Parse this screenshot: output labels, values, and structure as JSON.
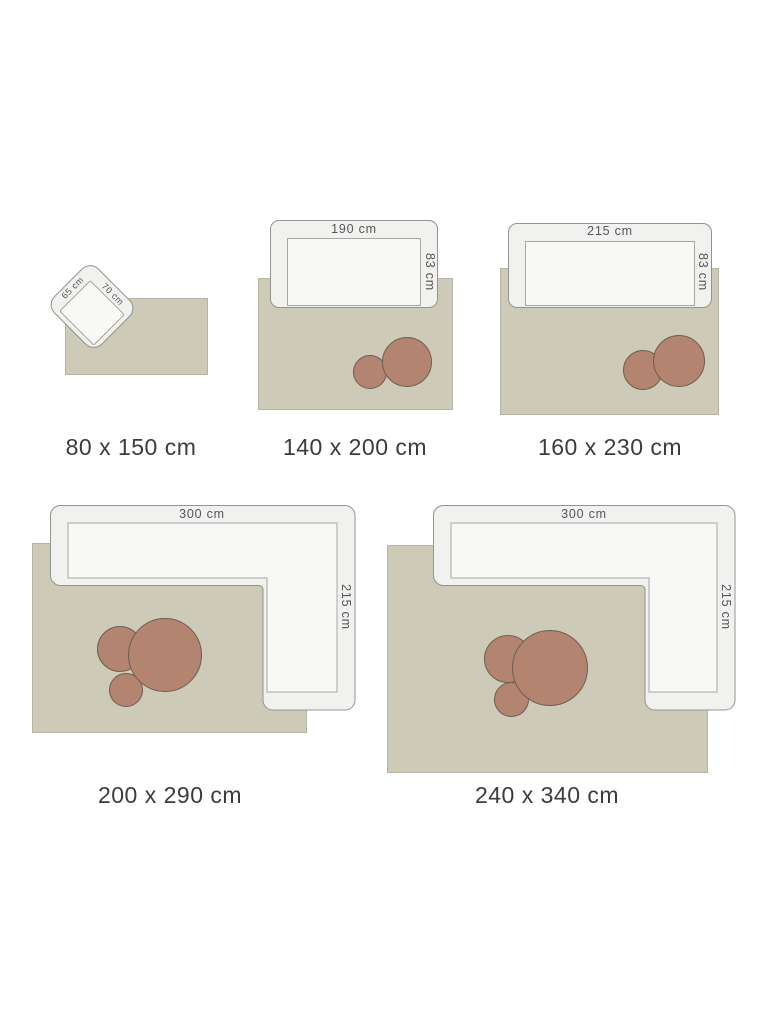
{
  "page": {
    "background": "#ffffff",
    "kind": "rug-size-guide"
  },
  "colors": {
    "rug_fill": "#cdcab7",
    "furniture_fill": "#f1f1ef",
    "furniture_seat_fill": "#f8f8f6",
    "furniture_border": "#94948c",
    "pouf_fill": "#b3846f",
    "pouf_border": "#6f5d51",
    "dimension_text": "#55555a",
    "caption_text": "#3c3c3e"
  },
  "panels": [
    {
      "size": "80 x 150 cm",
      "furniture": "armchair",
      "labels": {
        "width": "70 cm",
        "depth": "65 cm"
      },
      "poufs": 0
    },
    {
      "size": "140 x 200 cm",
      "furniture": "sofa",
      "labels": {
        "width": "190 cm",
        "depth": "83 cm"
      },
      "poufs": 2
    },
    {
      "size": "160 x 230 cm",
      "furniture": "sofa",
      "labels": {
        "width": "215 cm",
        "depth": "83 cm"
      },
      "poufs": 2
    },
    {
      "size": "200 x 290 cm",
      "furniture": "corner-sofa",
      "labels": {
        "width": "300 cm",
        "depth": "215 cm"
      },
      "poufs": 3
    },
    {
      "size": "240 x 340 cm",
      "furniture": "corner-sofa",
      "labels": {
        "width": "300 cm",
        "depth": "215 cm"
      },
      "poufs": 3
    }
  ]
}
